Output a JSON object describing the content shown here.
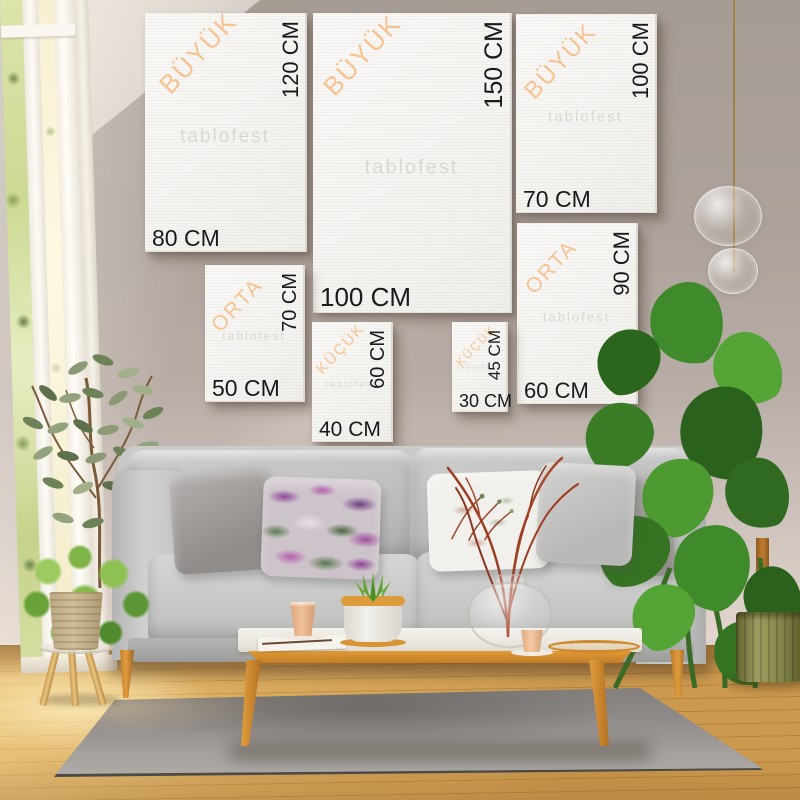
{
  "watermark": "tablofest",
  "colors": {
    "category_accent": "#f5c392",
    "size_label": "#1a1a1c",
    "wall": "#aca29b",
    "canvas": "#f6f5f2",
    "wood": "#d8922f",
    "rug": "#8f8b88"
  },
  "canvases": [
    {
      "category": "BÜYÜK",
      "width_label": "80 CM",
      "height_label": "120 CM"
    },
    {
      "category": "BÜYÜK",
      "width_label": "100 CM",
      "height_label": "150 CM"
    },
    {
      "category": "BÜYÜK",
      "width_label": "70 CM",
      "height_label": "100 CM"
    },
    {
      "category": "ORTA",
      "width_label": "50 CM",
      "height_label": "70 CM"
    },
    {
      "category": "ORTA",
      "width_label": "60 CM",
      "height_label": "90 CM"
    },
    {
      "category": "KÜÇÜK",
      "width_label": "40 CM",
      "height_label": "60 CM"
    },
    {
      "category": "KÜÇÜK",
      "width_label": "30 CM",
      "height_label": "45 CM"
    }
  ]
}
